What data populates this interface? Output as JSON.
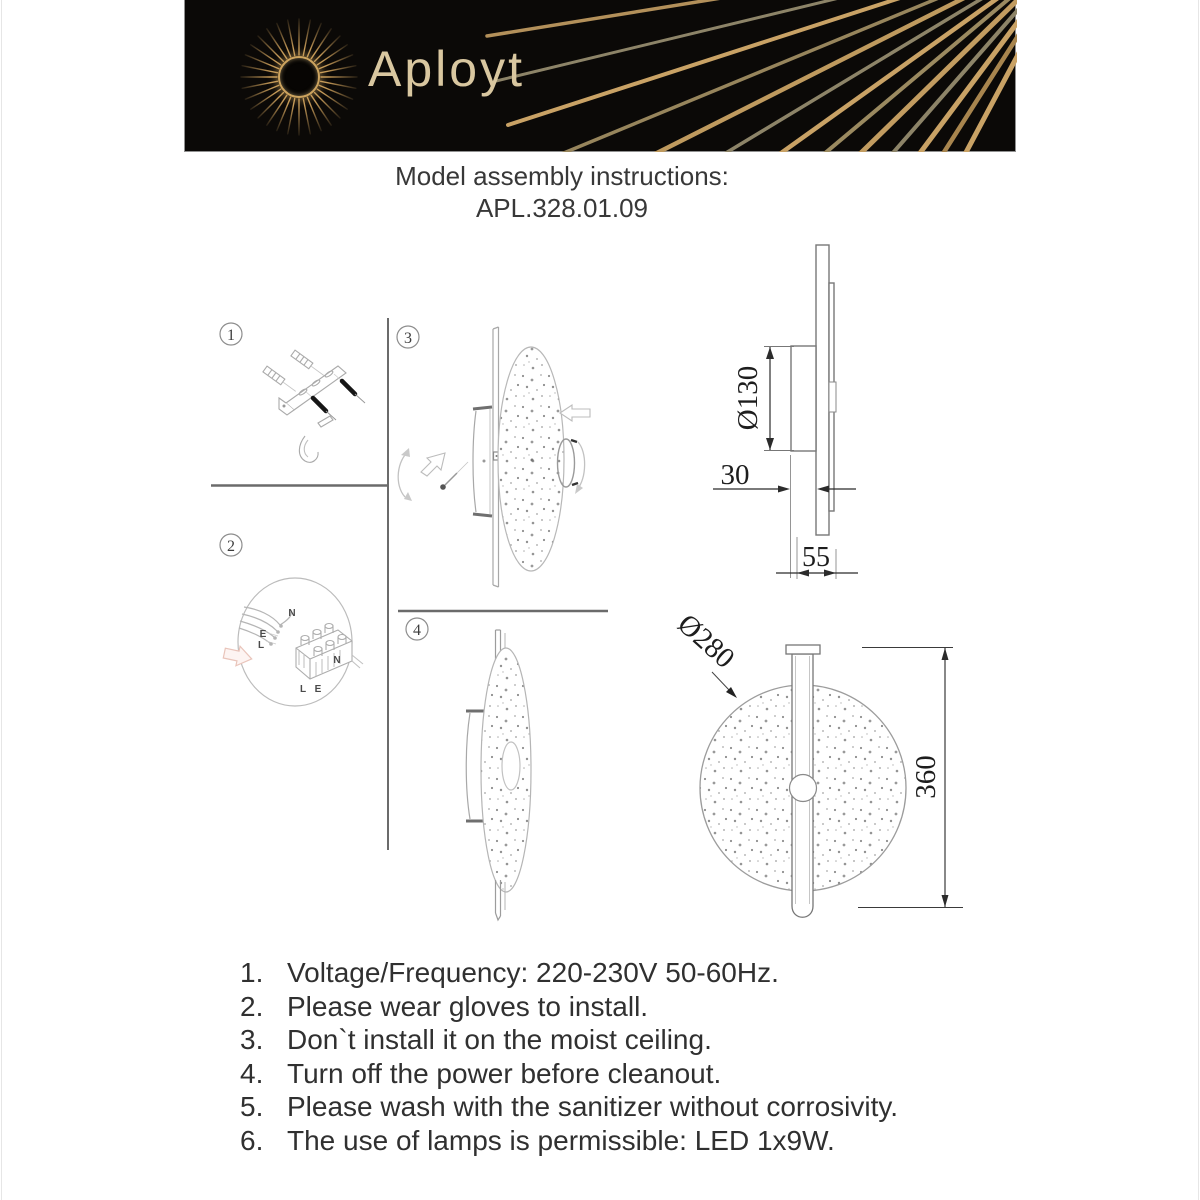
{
  "header": {
    "brand": "Aployt"
  },
  "title": {
    "line1": "Model assembly instructions:",
    "line2": "APL.328.01.09"
  },
  "steps": {
    "s1": "1",
    "s2": "2",
    "s3": "3",
    "s4": "4"
  },
  "wiring": {
    "n_top": "N",
    "e_left": "E",
    "l_left": "L",
    "n_right": "N",
    "l_bottom": "L",
    "e_bottom": "E"
  },
  "dimensions": {
    "side_diameter": "Ø130",
    "side_depth": "30",
    "side_total_depth": "55",
    "front_diameter": "Ø280",
    "front_height": "360"
  },
  "instructions": {
    "items": [
      {
        "num": "1.",
        "text": "Voltage/Frequency: 220-230V 50-60Hz."
      },
      {
        "num": "2.",
        "text": "Please wear gloves to install."
      },
      {
        "num": "3.",
        "text": "Don`t install it on the moist ceiling."
      },
      {
        "num": "4.",
        "text": "Turn off the power before cleanout."
      },
      {
        "num": "5.",
        "text": "Please wash with the sanitizer without corrosivity."
      },
      {
        "num": "6.",
        "text": "The use of lamps is permissible: LED 1x9W."
      }
    ]
  }
}
